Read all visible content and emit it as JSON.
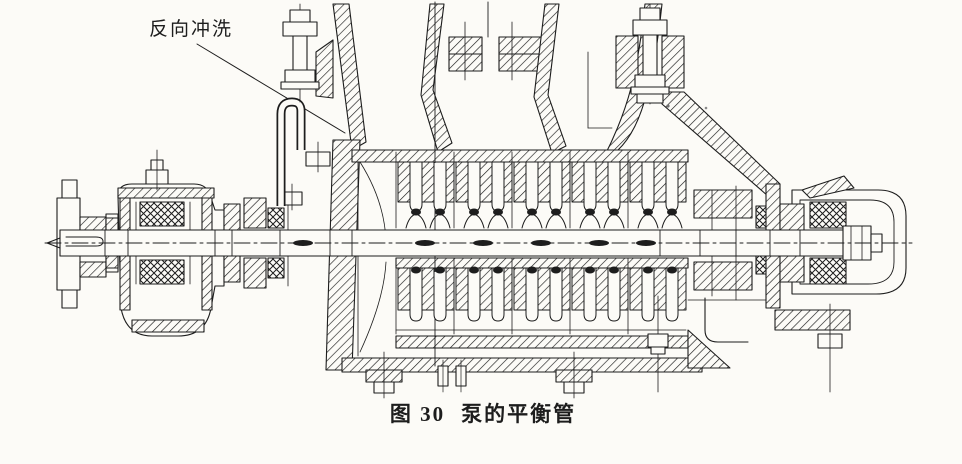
{
  "figure": {
    "annotation_label": "反向冲洗",
    "caption": {
      "number": "图 30",
      "title": "泵的平衡管"
    }
  },
  "colors": {
    "background": "#fcfbf7",
    "ink": "#1d1d1d"
  }
}
